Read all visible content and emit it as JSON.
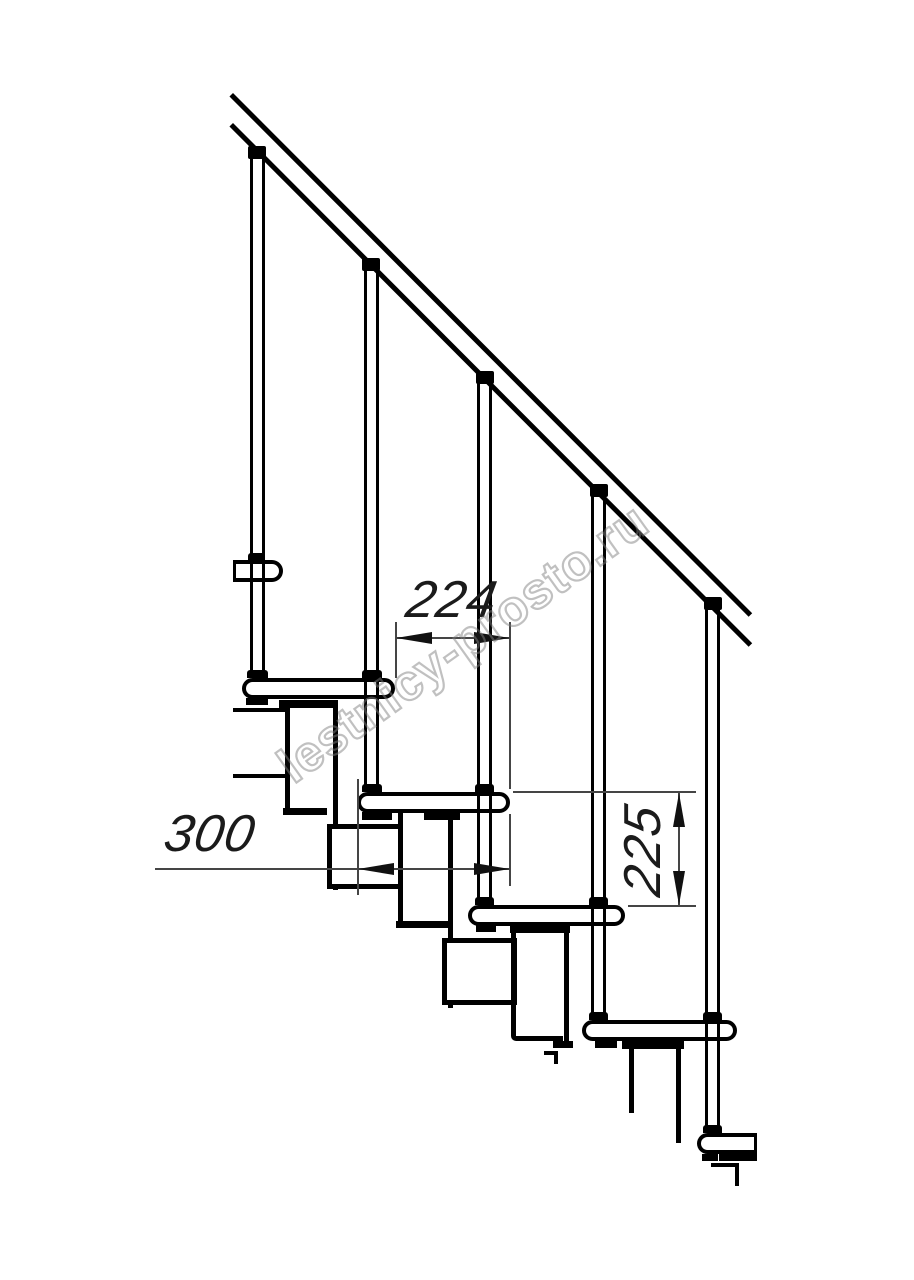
{
  "drawing": {
    "kind": "staircase-side-view",
    "watermark": {
      "text": "lestnicy-prosto.ru"
    },
    "dimensions": {
      "tread_run": {
        "label": "224"
      },
      "tread_depth": {
        "label": "300"
      },
      "step_rise": {
        "label": "225"
      }
    }
  }
}
